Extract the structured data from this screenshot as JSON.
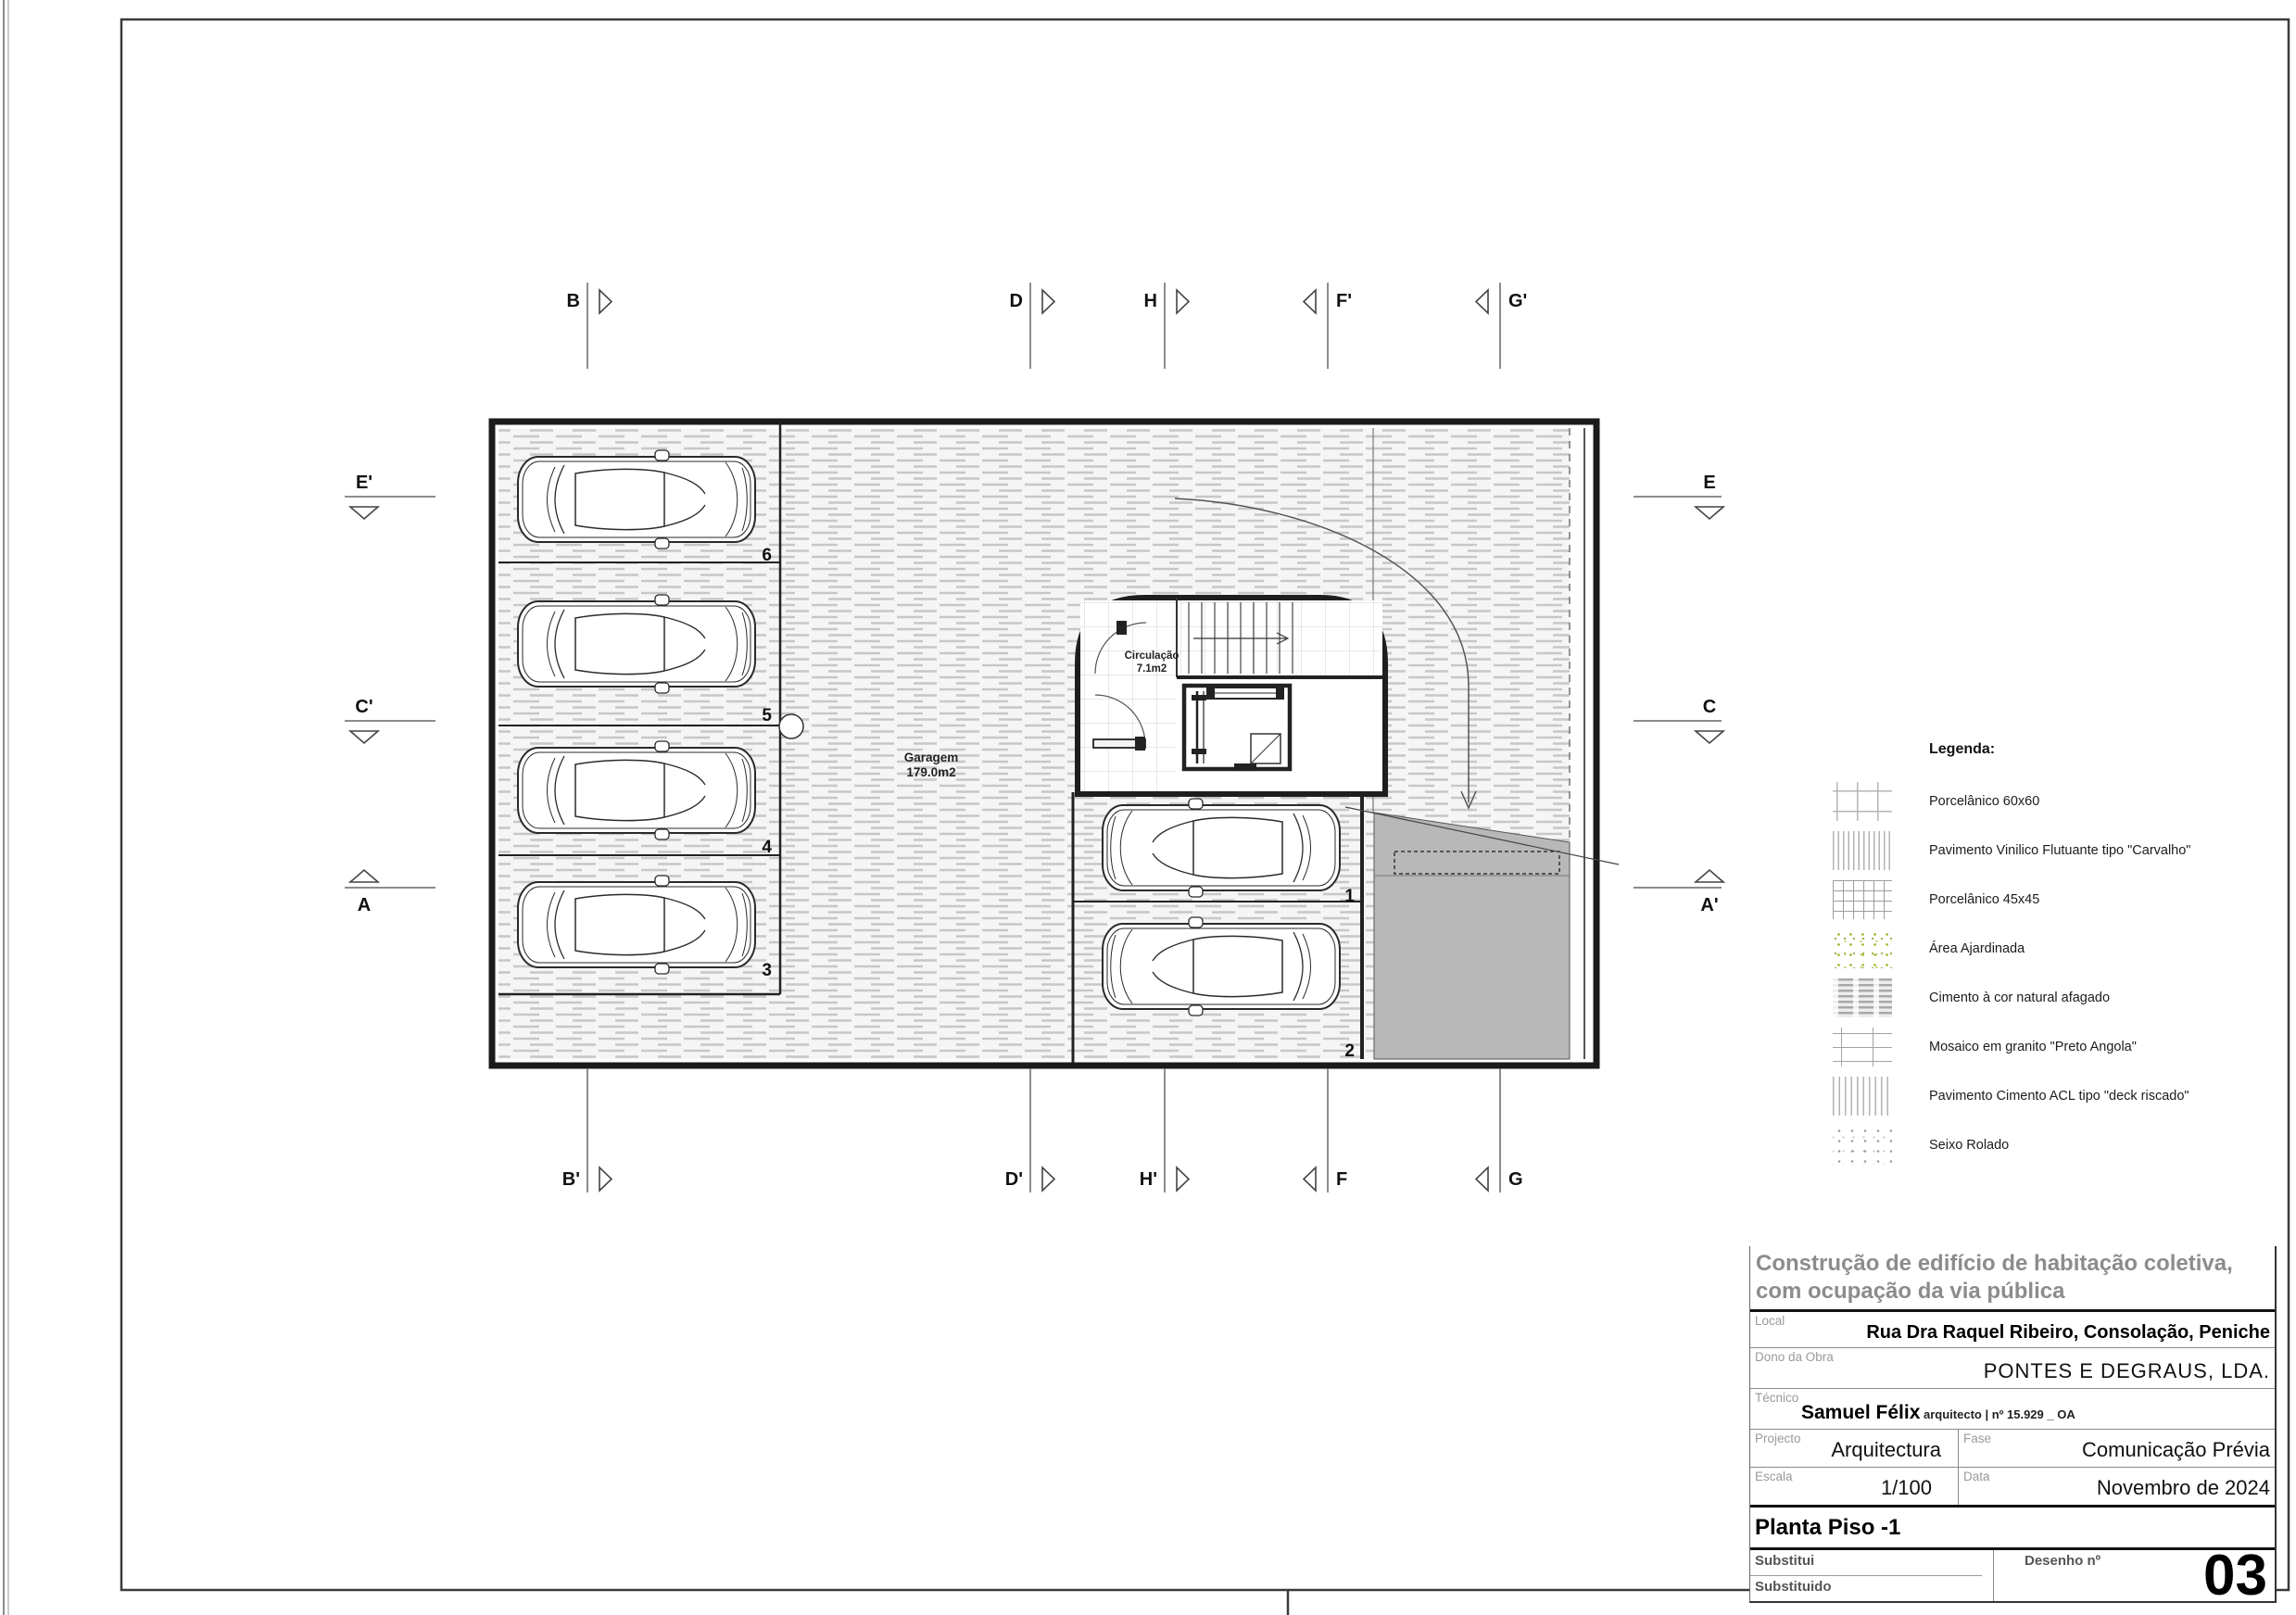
{
  "plan": {
    "garage": {
      "name": "Garagem",
      "area": "179.0m2"
    },
    "circulation": {
      "name": "Circulação",
      "area": "7.1m2"
    },
    "spaces": {
      "s1": "1",
      "s2": "2",
      "s3": "3",
      "s4": "4",
      "s5": "5",
      "s6": "6"
    }
  },
  "markers": {
    "b": "B",
    "b2": "B'",
    "d": "D",
    "d2": "D'",
    "h": "H",
    "h2": "H'",
    "f": "F",
    "f2": "F'",
    "g": "G",
    "g2": "G'",
    "e": "E",
    "e2": "E'",
    "c": "C",
    "c2": "C'",
    "a": "A",
    "a2": "A'"
  },
  "legend": {
    "title": "Legenda:",
    "items": [
      {
        "label": "Porcelânico 60x60",
        "swatch": "porcelanico-60x60-pattern"
      },
      {
        "label": "Pavimento Vinilico Flutuante tipo \"Carvalho\"",
        "swatch": "vinyl-plank-pattern"
      },
      {
        "label": "Porcelânico 45x45",
        "swatch": "porcelanico-45x45-pattern"
      },
      {
        "label": "Área Ajardinada",
        "swatch": "garden-area-pattern"
      },
      {
        "label": "Cimento à cor natural afagado",
        "swatch": "smoothed-cement-pattern"
      },
      {
        "label": "Mosaico em granito \"Preto Angola\"",
        "swatch": "granite-mosaic-pattern"
      },
      {
        "label": "Pavimento Cimento ACL tipo \"deck riscado\"",
        "swatch": "acl-cement-deck-pattern"
      },
      {
        "label": "Seixo Rolado",
        "swatch": "rolled-pebble-pattern"
      }
    ]
  },
  "title_block": {
    "project_title_line1": "Construção de edifício de habitação coletiva,",
    "project_title_line2": "com ocupação da via pública",
    "local_label": "Local",
    "local_value": "Rua Dra Raquel Ribeiro, Consolação, Peniche",
    "owner_label": "Dono da Obra",
    "owner_value": "PONTES E DEGRAUS, LDA.",
    "technician_label": "Técnico",
    "technician_name": "Samuel Félix",
    "technician_credentials": " arquitecto | nº 15.929 _ OA",
    "project_label": "Projecto",
    "project_value": "Arquitectura",
    "phase_label": "Fase",
    "phase_value": "Comunicação Prévia",
    "scale_label": "Escala",
    "scale_value": "1/100",
    "date_label": "Data",
    "date_value": "Novembro de 2024",
    "sheet_title": "Planta Piso -1",
    "replaces_label": "Substitui",
    "replaced_label": "Substituido",
    "drawing_no_label": "Desenho nº",
    "drawing_no": "03"
  }
}
